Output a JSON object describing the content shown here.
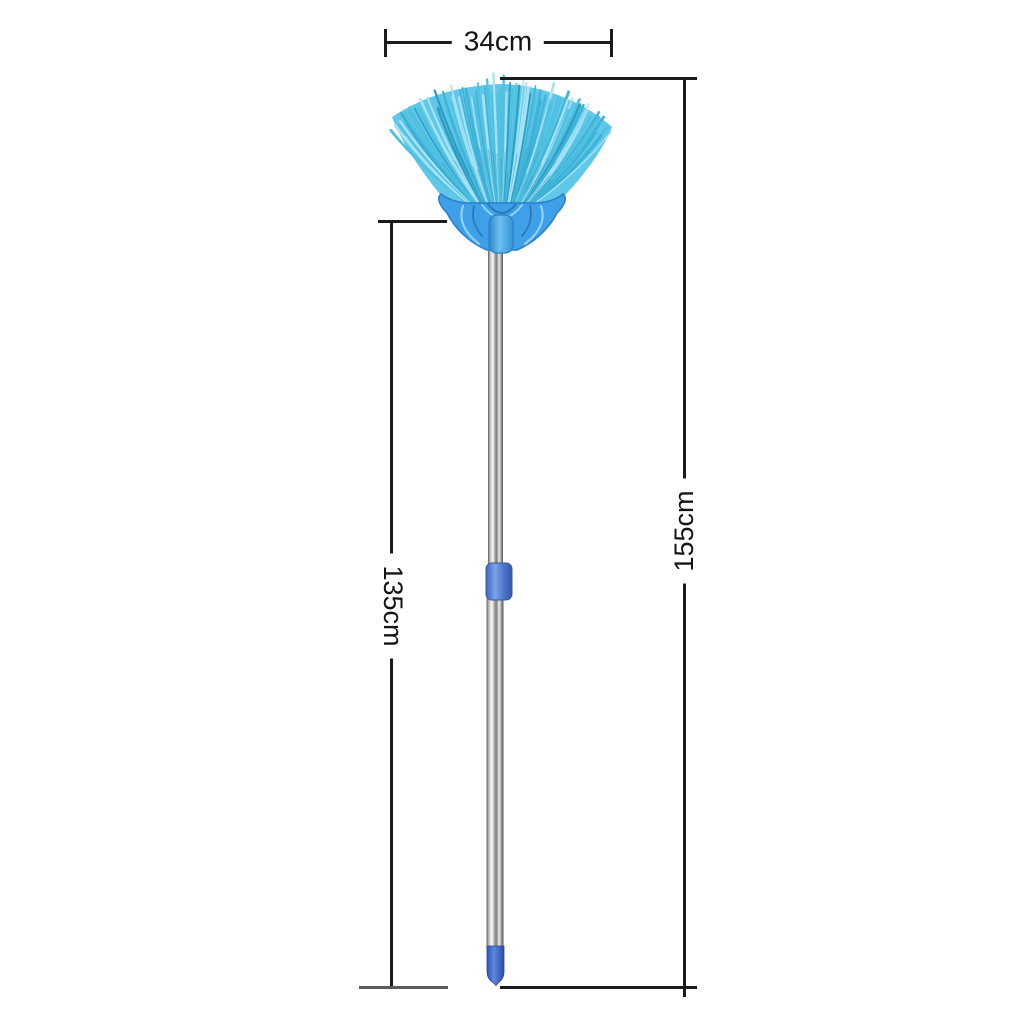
{
  "image": {
    "description": "Telescopic fan cobweb duster broom with dimension annotations",
    "background": "#ffffff"
  },
  "dimensions": {
    "head_width": {
      "label": "34cm"
    },
    "total_length": {
      "label": "155cm"
    },
    "pole_length": {
      "label": "135cm"
    },
    "line_color": "#1b1b1b"
  },
  "product": {
    "name": "fan-broom",
    "colors": {
      "bristle_light": "#a5e2f3",
      "bristle_mid": "#4fc0e0",
      "bristle_mid2": "#3eb2d8",
      "bristle_dark": "#2f9cc4",
      "fan_fill": "#5fc8e8",
      "head_base": "#3da0e8",
      "head_outline": "#2b7fc8",
      "head_decor_light": "#8fd2f4",
      "head_decor_dark": "#2e78b8",
      "neck": "#45a6ea",
      "collar_light": "#7da3e8",
      "collar_dark": "#3c66c4",
      "cap_light": "#5e86dc",
      "cap_dark": "#2d55b8",
      "pole_dark": "#5f5f5f",
      "pole_light": "#f8f8f8"
    }
  }
}
